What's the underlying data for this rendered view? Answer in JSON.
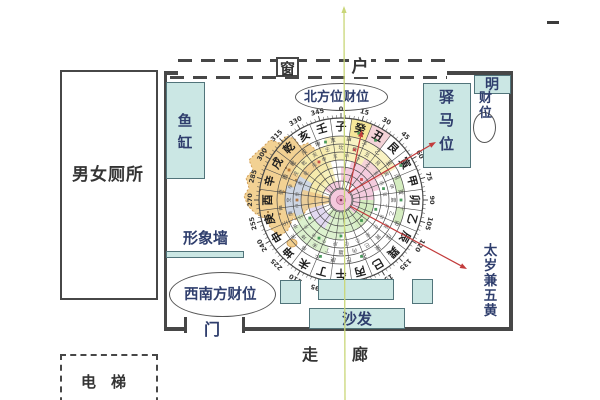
{
  "colors": {
    "teal_fill": "#cbe7e4",
    "teal_border": "#51747a",
    "wall": "#474747",
    "label_navy": "#2f3e6d",
    "label_dark": "#343434",
    "red": "#c23b3b",
    "axis_green": "#c9d678",
    "map_fill": "#f2cf8e",
    "map_border": "#cf9a52"
  },
  "window": {
    "char1": "窗",
    "char2": "户"
  },
  "room": {
    "toilet_label": "男女厕所",
    "fish_tank_label": "鱼缸",
    "post_horse_label": "驿马位",
    "bright_wealth_char": "明",
    "bright_wealth_rest": "财位",
    "north_wealth_label": "北方位财位",
    "southwest_wealth_label": "西南方财位",
    "image_wall_label": "形象墙",
    "sofa_label": "沙发",
    "door_label": "门",
    "taisui_label": "太岁兼五黄"
  },
  "outside": {
    "corridor_label": "走廊",
    "elevator_label": "电梯",
    "top_right_dash": "–"
  },
  "compass": {
    "degree_labels": [
      "0",
      "15",
      "30",
      "45",
      "60",
      "75",
      "90",
      "105",
      "120",
      "135",
      "150",
      "165",
      "180",
      "195",
      "210",
      "225",
      "240",
      "255",
      "270",
      "285",
      "300",
      "315",
      "330",
      "345"
    ],
    "mountains": [
      "子",
      "癸",
      "丑",
      "艮",
      "寅",
      "甲",
      "卯",
      "乙",
      "辰",
      "巽",
      "巳",
      "丙",
      "午",
      "丁",
      "未",
      "坤",
      "申",
      "庚",
      "酉",
      "辛",
      "戌",
      "乾",
      "亥",
      "壬"
    ],
    "inner_ring1": [
      "甲",
      "子",
      "乙",
      "丑",
      "丙",
      "寅",
      "丁",
      "卯",
      "戊",
      "辰",
      "己",
      "巳",
      "庚",
      "午",
      "辛",
      "未",
      "壬",
      "申",
      "癸",
      "酉",
      "乾",
      "戌",
      "坤",
      "亥"
    ],
    "inner_ring2": [
      "坎",
      "癸",
      "丑",
      "艮",
      "寅",
      "甲",
      "震",
      "乙",
      "辰",
      "巽",
      "巳",
      "丙",
      "離",
      "丁",
      "未",
      "坤",
      "申",
      "庚",
      "兌",
      "辛",
      "戌",
      "乾",
      "亥",
      "壬"
    ],
    "sectors": [
      [
        64,
        82,
        7.5,
        22.5,
        "#f5e387"
      ],
      [
        64,
        82,
        22.5,
        37.5,
        "#f3cbd1"
      ],
      [
        56,
        64,
        -15,
        60,
        "#f8f0b8"
      ],
      [
        56,
        64,
        67.5,
        82.5,
        "#cce9b5"
      ],
      [
        56,
        64,
        97.5,
        112.5,
        "#cce9b5"
      ],
      [
        48,
        56,
        -60,
        60,
        "#f7eeb0"
      ],
      [
        48,
        56,
        255,
        285,
        "#c8d7f2"
      ],
      [
        48,
        56,
        195,
        240,
        "#d6eec6"
      ],
      [
        40,
        48,
        250,
        300,
        "#c8d7f2"
      ],
      [
        40,
        48,
        200,
        250,
        "#d6eec6"
      ],
      [
        40,
        48,
        -30,
        30,
        "#f7eeb0"
      ],
      [
        40,
        48,
        30,
        60,
        "#f3cbd1"
      ],
      [
        33,
        40,
        255,
        300,
        "#c8d7f2"
      ],
      [
        33,
        40,
        180,
        240,
        "#d6eec6"
      ],
      [
        33,
        40,
        300,
        345,
        "#f7eeb0"
      ],
      [
        33,
        40,
        15,
        75,
        "#f2c3d8"
      ],
      [
        19,
        33,
        0,
        90,
        "#f2c3d8"
      ],
      [
        19,
        33,
        90,
        150,
        "#cce9b5"
      ],
      [
        19,
        33,
        150,
        210,
        "#d6eec6"
      ],
      [
        19,
        33,
        210,
        255,
        "#ddd2ee"
      ],
      [
        19,
        33,
        285,
        345,
        "#f7eeb0"
      ],
      [
        12,
        19,
        45,
        135,
        "#f2c3d8"
      ],
      [
        12,
        19,
        135,
        225,
        "#cce9b5"
      ],
      [
        12,
        19,
        300,
        360,
        "#f2c3d8"
      ],
      [
        12,
        40,
        255,
        285,
        "#f0cd8d"
      ]
    ],
    "map_points": [
      [
        262,
        148
      ],
      [
        270,
        140
      ],
      [
        280,
        143
      ],
      [
        286,
        136
      ],
      [
        295,
        139
      ],
      [
        300,
        146
      ],
      [
        308,
        143
      ],
      [
        316,
        150
      ],
      [
        322,
        147
      ],
      [
        328,
        153
      ],
      [
        324,
        160
      ],
      [
        330,
        166
      ],
      [
        322,
        173
      ],
      [
        327,
        181
      ],
      [
        318,
        188
      ],
      [
        322,
        197
      ],
      [
        312,
        203
      ],
      [
        305,
        212
      ],
      [
        300,
        222
      ],
      [
        293,
        218
      ],
      [
        288,
        230
      ],
      [
        280,
        236
      ],
      [
        271,
        229
      ],
      [
        266,
        219
      ],
      [
        256,
        214
      ],
      [
        248,
        206
      ],
      [
        244,
        196
      ],
      [
        249,
        188
      ],
      [
        246,
        178
      ],
      [
        253,
        170
      ],
      [
        249,
        160
      ],
      [
        256,
        153
      ]
    ],
    "map_dots": [
      [
        266,
        152
      ],
      [
        276,
        160
      ],
      [
        286,
        168
      ],
      [
        272,
        178
      ],
      [
        260,
        190
      ],
      [
        270,
        200
      ],
      [
        284,
        192
      ],
      [
        296,
        180
      ],
      [
        304,
        168
      ],
      [
        290,
        150
      ],
      [
        300,
        196
      ],
      [
        280,
        214
      ],
      [
        292,
        206
      ],
      [
        268,
        212
      ]
    ],
    "markers": [
      [
        15,
        69,
        "#2e8b44"
      ],
      [
        30,
        69,
        "#2e8b44"
      ],
      [
        60,
        69,
        "#2e8b44"
      ],
      [
        90,
        60,
        "#2e8b44"
      ],
      [
        345,
        60,
        "#2e8b44"
      ],
      [
        15,
        52,
        "#c2383b"
      ],
      [
        75,
        44,
        "#2e8b44"
      ],
      [
        105,
        36,
        "#2e8b44"
      ],
      [
        210,
        44,
        "#2e8b44"
      ],
      [
        240,
        36,
        "#2e8b44"
      ],
      [
        300,
        60,
        "#b06a2a"
      ],
      [
        135,
        29,
        "#2e8b44"
      ],
      [
        180,
        36,
        "#2e8b44"
      ],
      [
        270,
        44,
        "#b06a2a"
      ],
      [
        330,
        44,
        "#c2383b"
      ],
      [
        45,
        29,
        "#c2383b"
      ],
      [
        160,
        60,
        "#2e8b44"
      ],
      [
        200,
        60,
        "#2e8b44"
      ]
    ],
    "annotations": {
      "red_arrows": [
        {
          "x1": 348,
          "y1": 193,
          "x2": 436,
          "y2": 142
        },
        {
          "x1": 349,
          "y1": 191,
          "x2": 362,
          "y2": 130
        },
        {
          "x1": 350,
          "y1": 206,
          "x2": 467,
          "y2": 269
        }
      ],
      "green_axis": {
        "x1": 345,
        "y1": 400,
        "x2": 344,
        "y2": 6
      }
    }
  }
}
